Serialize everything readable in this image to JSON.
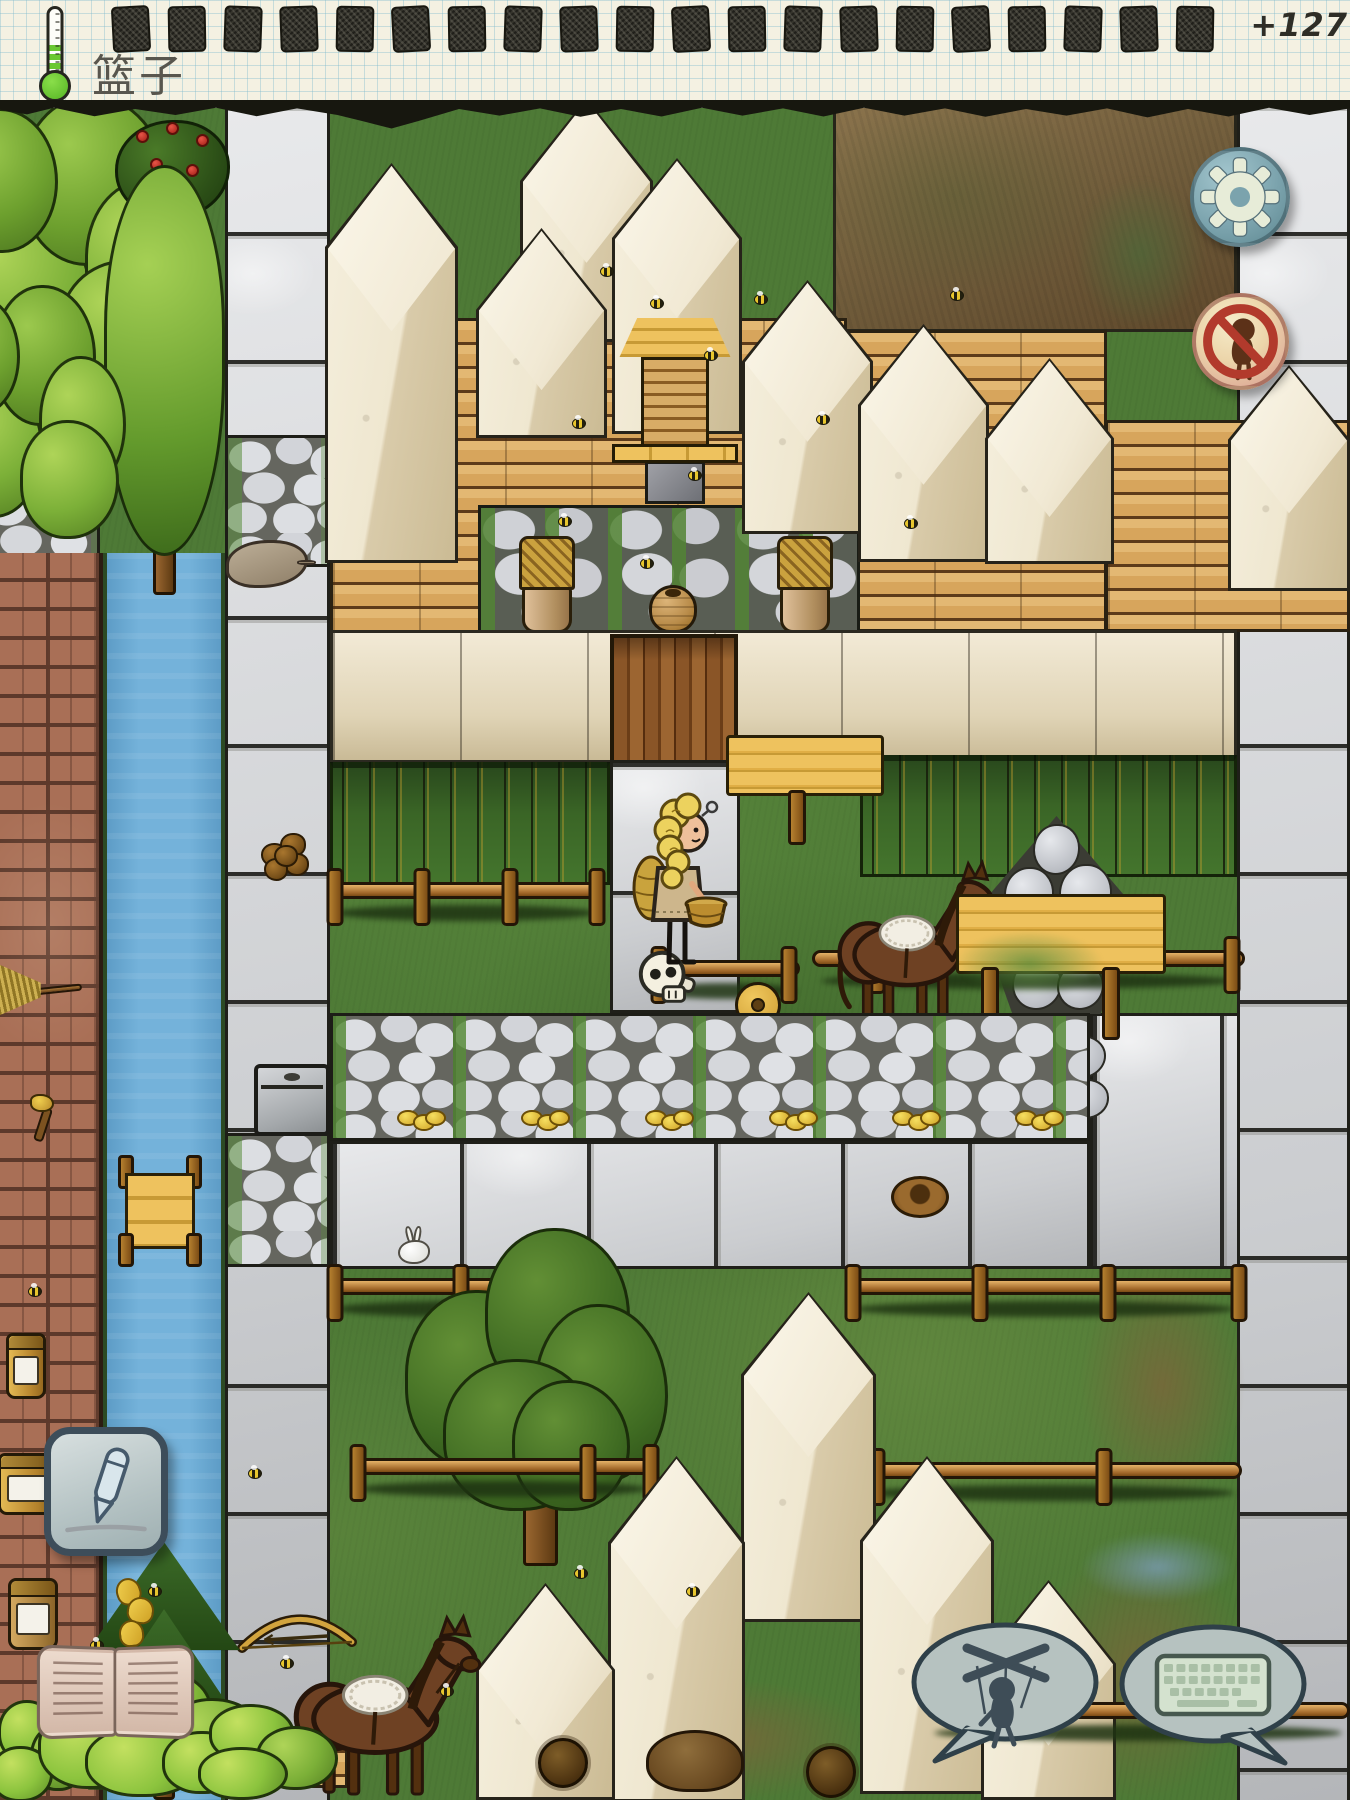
{
  "hud": {
    "item_label": "篮子",
    "score": "+127",
    "food_pips": 20,
    "thermometer": {
      "icon": "thermometer-icon",
      "fill_level": 0.46,
      "fill_color": "#6ac832"
    },
    "buttons": [
      {
        "name": "settings-button",
        "icon": "gear-icon"
      },
      {
        "name": "no-children-button",
        "icon": "no-baby-icon"
      },
      {
        "name": "draw-button",
        "icon": "pen-icon"
      },
      {
        "name": "family-book-button",
        "icon": "open-book-icon"
      },
      {
        "name": "mute-speech-button",
        "icon": "marionette-icon"
      },
      {
        "name": "keyboard-chat-button",
        "icon": "keyboard-icon"
      }
    ]
  },
  "palette": {
    "paper": "#f4f1e2",
    "grid_line": "#7db9cd",
    "ink": "#2e2d26",
    "grass": "#4e7a36",
    "river": "#74b2da",
    "road": "#cbcdd0",
    "brick": "#a96f56",
    "plank": "#d7a55c",
    "adobe": "#ede3cc",
    "sign_yellow": "#eec25e",
    "button_blue": "#7ba3ad",
    "alert_red": "#b23a2c"
  },
  "world": {
    "width": 1350,
    "height": 1800,
    "objects": [
      {
        "type": "dirt",
        "x": 833,
        "y": 104,
        "w": 404,
        "h": 228
      },
      {
        "type": "puddle-green",
        "x": 1075,
        "y": 178,
        "w": 130,
        "h": 150
      },
      {
        "type": "road-col",
        "x": 225,
        "y": 104,
        "w": 105,
        "h": 1696
      },
      {
        "type": "cobble",
        "x": 225,
        "y": 435,
        "w": 105,
        "h": 132
      },
      {
        "type": "cobble",
        "x": 225,
        "y": 1133,
        "w": 105,
        "h": 134
      },
      {
        "type": "road-col",
        "x": 1237,
        "y": 104,
        "w": 113,
        "h": 1696
      },
      {
        "type": "road-block",
        "x": 1090,
        "y": 1013,
        "w": 150,
        "h": 256,
        "seams": "hv"
      },
      {
        "type": "river",
        "x": 103,
        "y": 553,
        "w": 122,
        "h": 1247
      },
      {
        "type": "cobble",
        "x": -18,
        "y": 488,
        "w": 118,
        "h": 100
      },
      {
        "type": "brick",
        "x": 0,
        "y": 553,
        "w": 103,
        "h": 1247
      },
      {
        "type": "tree-round",
        "x": -55,
        "y": 88,
        "w": 270,
        "h": 330
      },
      {
        "type": "rosebush",
        "x": 115,
        "y": 120,
        "w": 115,
        "h": 100
      },
      {
        "type": "tree-poplar",
        "x": 92,
        "y": 165,
        "w": 145,
        "h": 430
      },
      {
        "type": "tree-round",
        "x": -60,
        "y": 280,
        "w": 190,
        "h": 270
      },
      {
        "type": "planks",
        "x": 330,
        "y": 318,
        "w": 517,
        "h": 315
      },
      {
        "type": "planks",
        "x": 845,
        "y": 330,
        "w": 262,
        "h": 302
      },
      {
        "type": "planks",
        "x": 1105,
        "y": 420,
        "w": 245,
        "h": 212
      },
      {
        "type": "stonewall",
        "x": 478,
        "y": 505,
        "w": 382,
        "h": 128
      },
      {
        "type": "prism",
        "x": 520,
        "y": 98,
        "w": 133,
        "h": 244
      },
      {
        "type": "prism",
        "x": 325,
        "y": 163,
        "w": 133,
        "h": 400
      },
      {
        "type": "prism",
        "x": 612,
        "y": 158,
        "w": 130,
        "h": 276
      },
      {
        "type": "prism",
        "x": 476,
        "y": 228,
        "w": 131,
        "h": 210
      },
      {
        "type": "prism",
        "x": 742,
        "y": 280,
        "w": 131,
        "h": 254
      },
      {
        "type": "prism",
        "x": 858,
        "y": 324,
        "w": 131,
        "h": 238
      },
      {
        "type": "prism",
        "x": 985,
        "y": 358,
        "w": 129,
        "h": 206
      },
      {
        "type": "prism",
        "x": 1228,
        "y": 365,
        "w": 122,
        "h": 226
      },
      {
        "type": "hive",
        "x": 612,
        "y": 318,
        "w": 126,
        "h": 186
      },
      {
        "type": "basketpot",
        "x": 519,
        "y": 536,
        "w": 56,
        "h": 97
      },
      {
        "type": "basketpot",
        "x": 777,
        "y": 536,
        "w": 56,
        "h": 97
      },
      {
        "type": "amphora",
        "x": 649,
        "y": 585,
        "w": 48,
        "h": 48
      },
      {
        "type": "adobe-row",
        "x": 330,
        "y": 630,
        "w": 907,
        "h": 133
      },
      {
        "type": "door",
        "x": 610,
        "y": 634,
        "w": 128,
        "h": 130
      },
      {
        "type": "crops",
        "x": 330,
        "y": 762,
        "w": 280,
        "h": 123
      },
      {
        "type": "crops",
        "x": 860,
        "y": 755,
        "w": 377,
        "h": 122
      },
      {
        "type": "road-block",
        "x": 610,
        "y": 760,
        "w": 130,
        "h": 253,
        "seams": "h"
      },
      {
        "type": "sign",
        "x": 726,
        "y": 735,
        "w": 158,
        "h": 110,
        "posts": [
          0.45
        ]
      },
      {
        "type": "fence",
        "x": 330,
        "y": 868,
        "w": 272,
        "h": 82,
        "posts": [
          0.02,
          0.34,
          0.66,
          0.98
        ]
      },
      {
        "type": "rockpile",
        "x": 983,
        "y": 816,
        "w": 147,
        "h": 198
      },
      {
        "type": "rocks-small",
        "x": 1002,
        "y": 1010,
        "w": 116,
        "h": 124
      },
      {
        "type": "fence",
        "x": 812,
        "y": 936,
        "w": 433,
        "h": 78,
        "posts": [
          0.15,
          0.97
        ]
      },
      {
        "type": "fence",
        "x": 648,
        "y": 946,
        "w": 152,
        "h": 70,
        "posts": [
          0.07,
          0.93
        ]
      },
      {
        "type": "skull",
        "x": 634,
        "y": 948,
        "w": 68,
        "h": 62
      },
      {
        "type": "wheel",
        "x": 735,
        "y": 982,
        "w": 46,
        "h": 46
      },
      {
        "type": "horse",
        "x": 830,
        "y": 858,
        "w": 175,
        "h": 170
      },
      {
        "type": "sign",
        "x": 956,
        "y": 894,
        "w": 210,
        "h": 146,
        "posts": [
          0.16,
          0.74
        ],
        "moss": true
      },
      {
        "type": "cobble-row",
        "x": 330,
        "y": 1013,
        "w": 760,
        "h": 128
      },
      {
        "type": "coins",
        "x": 397,
        "y": 1110,
        "w": 48,
        "h": 24
      },
      {
        "type": "coins",
        "x": 521,
        "y": 1110,
        "w": 48,
        "h": 24
      },
      {
        "type": "coins",
        "x": 645,
        "y": 1110,
        "w": 48,
        "h": 24
      },
      {
        "type": "coins",
        "x": 769,
        "y": 1110,
        "w": 48,
        "h": 24
      },
      {
        "type": "coins",
        "x": 892,
        "y": 1110,
        "w": 48,
        "h": 24
      },
      {
        "type": "coins",
        "x": 1015,
        "y": 1110,
        "w": 48,
        "h": 24
      },
      {
        "type": "road-block",
        "x": 330,
        "y": 1141,
        "w": 760,
        "h": 128,
        "seams": "v"
      },
      {
        "type": "lady",
        "x": 628,
        "y": 792,
        "w": 100,
        "h": 180
      },
      {
        "type": "dirt-soft",
        "x": 1080,
        "y": 1265,
        "w": 165,
        "h": 240
      },
      {
        "type": "dirt-soft",
        "x": 1030,
        "y": 1545,
        "w": 220,
        "h": 255
      },
      {
        "type": "dirt-soft",
        "x": 590,
        "y": 1680,
        "w": 280,
        "h": 120
      },
      {
        "type": "puddle-blue",
        "x": 1080,
        "y": 1532,
        "w": 155,
        "h": 70
      },
      {
        "type": "fence",
        "x": 330,
        "y": 1264,
        "w": 262,
        "h": 84,
        "posts": [
          0.02,
          0.5,
          0.98
        ]
      },
      {
        "type": "fence",
        "x": 845,
        "y": 1264,
        "w": 398,
        "h": 84,
        "posts": [
          0.02,
          0.34,
          0.66,
          0.99
        ]
      },
      {
        "type": "tree-apple",
        "x": 405,
        "y": 1228,
        "w": 268,
        "h": 345
      },
      {
        "type": "bunny",
        "x": 393,
        "y": 1226,
        "w": 42,
        "h": 40
      },
      {
        "type": "nest",
        "x": 891,
        "y": 1176,
        "w": 58,
        "h": 42
      },
      {
        "type": "fence",
        "x": 352,
        "y": 1444,
        "w": 302,
        "h": 88,
        "posts": [
          0.02,
          0.78,
          0.99
        ]
      },
      {
        "type": "fence",
        "x": 858,
        "y": 1448,
        "w": 384,
        "h": 84,
        "posts": [
          0.05,
          0.64
        ]
      },
      {
        "type": "prism",
        "x": 741,
        "y": 1292,
        "w": 135,
        "h": 330
      },
      {
        "type": "prism",
        "x": 608,
        "y": 1456,
        "w": 137,
        "h": 346
      },
      {
        "type": "prism",
        "x": 860,
        "y": 1456,
        "w": 134,
        "h": 338
      },
      {
        "type": "prism",
        "x": 476,
        "y": 1583,
        "w": 139,
        "h": 217
      },
      {
        "type": "prism",
        "x": 981,
        "y": 1580,
        "w": 135,
        "h": 220
      },
      {
        "type": "fence",
        "x": 926,
        "y": 1688,
        "w": 424,
        "h": 88,
        "posts": [
          0.76
        ]
      },
      {
        "type": "dock",
        "x": 116,
        "y": 1155,
        "w": 88,
        "h": 112
      },
      {
        "type": "carcass",
        "x": 226,
        "y": 540,
        "w": 82,
        "h": 48
      },
      {
        "type": "nutpile",
        "x": 256,
        "y": 826,
        "w": 60,
        "h": 58
      },
      {
        "type": "box",
        "x": 254,
        "y": 1064,
        "w": 76,
        "h": 72
      },
      {
        "type": "bow",
        "x": 236,
        "y": 1606,
        "w": 122,
        "h": 48
      },
      {
        "type": "broom",
        "x": -4,
        "y": 962,
        "w": 86,
        "h": 56
      },
      {
        "type": "axe",
        "x": 20,
        "y": 1094,
        "w": 46,
        "h": 50
      },
      {
        "type": "jar",
        "x": 6,
        "y": 1333,
        "w": 40,
        "h": 66
      },
      {
        "type": "jar",
        "x": -2,
        "y": 1453,
        "w": 58,
        "h": 62
      },
      {
        "type": "pine",
        "x": 88,
        "y": 1542,
        "w": 152,
        "h": 258
      },
      {
        "type": "bananas",
        "x": 113,
        "y": 1575,
        "w": 48,
        "h": 80
      },
      {
        "type": "jar-honey",
        "x": 8,
        "y": 1578,
        "w": 50,
        "h": 72
      },
      {
        "type": "planks",
        "x": 260,
        "y": 1726,
        "w": 88,
        "h": 62
      },
      {
        "type": "horse",
        "x": 285,
        "y": 1612,
        "w": 205,
        "h": 188
      },
      {
        "type": "bush",
        "x": -35,
        "y": 1698,
        "w": 125,
        "h": 108
      },
      {
        "type": "bush",
        "x": 38,
        "y": 1665,
        "w": 235,
        "h": 138
      },
      {
        "type": "bush",
        "x": 162,
        "y": 1702,
        "w": 180,
        "h": 102
      },
      {
        "type": "mound",
        "x": 646,
        "y": 1730,
        "w": 98,
        "h": 62
      },
      {
        "type": "burr",
        "x": 538,
        "y": 1738,
        "w": 50,
        "h": 50
      },
      {
        "type": "burr",
        "x": 806,
        "y": 1746,
        "w": 50,
        "h": 52
      },
      {
        "type": "bee",
        "x": 600,
        "y": 266,
        "w": 14,
        "h": 11
      },
      {
        "type": "bee",
        "x": 650,
        "y": 298,
        "w": 14,
        "h": 11
      },
      {
        "type": "bee",
        "x": 704,
        "y": 350,
        "w": 14,
        "h": 11
      },
      {
        "type": "bee",
        "x": 754,
        "y": 294,
        "w": 14,
        "h": 11
      },
      {
        "type": "bee",
        "x": 572,
        "y": 418,
        "w": 14,
        "h": 11
      },
      {
        "type": "bee",
        "x": 688,
        "y": 470,
        "w": 14,
        "h": 11
      },
      {
        "type": "bee",
        "x": 816,
        "y": 414,
        "w": 14,
        "h": 11
      },
      {
        "type": "bee",
        "x": 558,
        "y": 516,
        "w": 14,
        "h": 11
      },
      {
        "type": "bee",
        "x": 904,
        "y": 518,
        "w": 14,
        "h": 11
      },
      {
        "type": "bee",
        "x": 950,
        "y": 290,
        "w": 14,
        "h": 11
      },
      {
        "type": "bee",
        "x": 640,
        "y": 558,
        "w": 14,
        "h": 11
      },
      {
        "type": "bee",
        "x": 148,
        "y": 1586,
        "w": 14,
        "h": 11
      },
      {
        "type": "bee",
        "x": 90,
        "y": 1640,
        "w": 14,
        "h": 11
      },
      {
        "type": "bee",
        "x": 280,
        "y": 1658,
        "w": 14,
        "h": 11
      },
      {
        "type": "bee",
        "x": 440,
        "y": 1686,
        "w": 14,
        "h": 11
      },
      {
        "type": "bee",
        "x": 686,
        "y": 1586,
        "w": 14,
        "h": 11
      },
      {
        "type": "bee",
        "x": 574,
        "y": 1568,
        "w": 14,
        "h": 11
      },
      {
        "type": "bee",
        "x": 28,
        "y": 1286,
        "w": 14,
        "h": 11
      },
      {
        "type": "bee",
        "x": 248,
        "y": 1468,
        "w": 14,
        "h": 11
      },
      {
        "type": "bee",
        "x": 116,
        "y": 1538,
        "w": 14,
        "h": 11
      }
    ]
  }
}
